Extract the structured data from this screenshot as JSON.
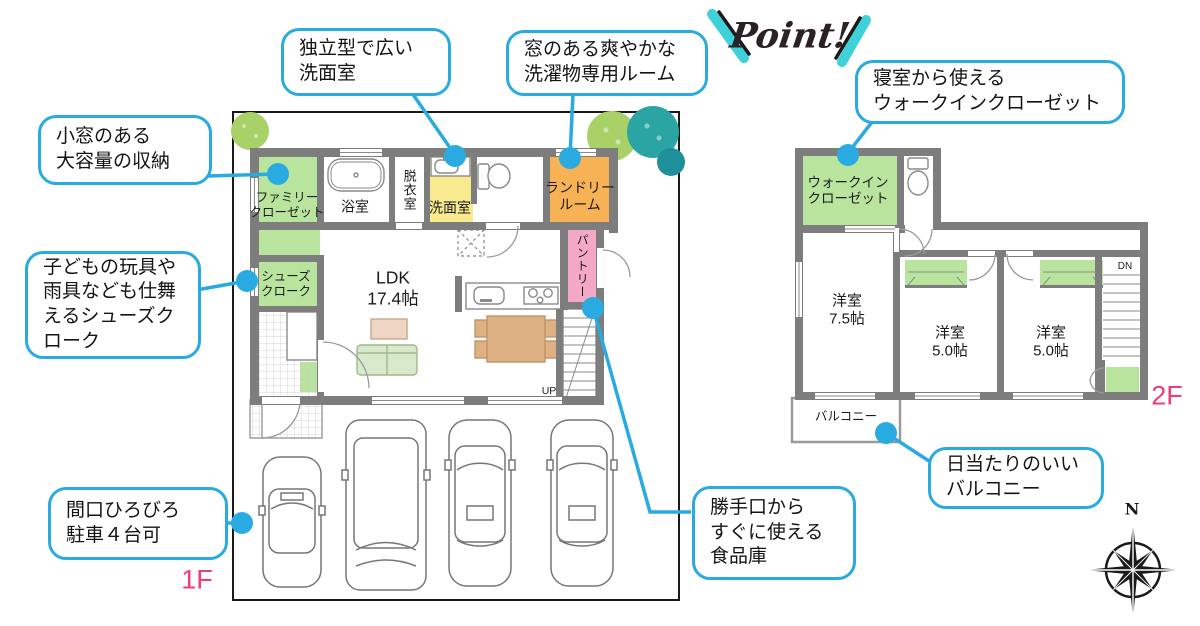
{
  "logo": {
    "text": "Point!"
  },
  "callouts": {
    "washroom": "独立型で広い\n洗面室",
    "laundry": "窓のある爽やかな\n洗濯物専用ルーム",
    "wic": "寝室から使える\nウォークインクローゼット",
    "storage": "小窓のある\n大容量の収納",
    "shoes": "子どもの玩具や\n雨具なども仕舞\nえるシューズク\nローク",
    "parking": "間口ひろびろ\n駐車４台可",
    "pantry": "勝手口から\nすぐに使える\n食品庫",
    "balcony": "日当たりのいい\nバルコニー"
  },
  "floor1": {
    "label": "1F",
    "rooms": {
      "family_closet": "ファミリー\nクローゼット",
      "bathroom": "浴室",
      "dressing_room": "脱衣室",
      "washroom": "洗面室",
      "laundry_room": "ランドリー\nルーム",
      "pantry": "パントリー",
      "shoes_cloak": "シューズ\nクローク",
      "ldk": "LDK\n17.4帖",
      "stairs_up": "UP"
    }
  },
  "floor2": {
    "label": "2F",
    "rooms": {
      "walk_in_closet": "ウォークイン\nクローゼット",
      "bedroom_75": "洋室\n7.5帖",
      "bedroom_50a": "洋室\n5.0帖",
      "bedroom_50b": "洋室\n5.0帖",
      "balcony": "バルコニー",
      "stairs_dn": "DN"
    }
  },
  "compass": {
    "north": "N"
  },
  "colors": {
    "accent_blue": "#29abe2",
    "room_green": "#b9e49d",
    "room_yellow": "#f8ea8e",
    "room_orange": "#f6b254",
    "room_pink": "#f3a9c6",
    "wall_gray": "#7d7d7d",
    "floor_tag_pink": "#ee3d78",
    "tree_green": "#a8d168",
    "tree_teal": "#2aa5a3",
    "furniture_tan": "#deb184",
    "sofa_green": "#d8eacb"
  }
}
